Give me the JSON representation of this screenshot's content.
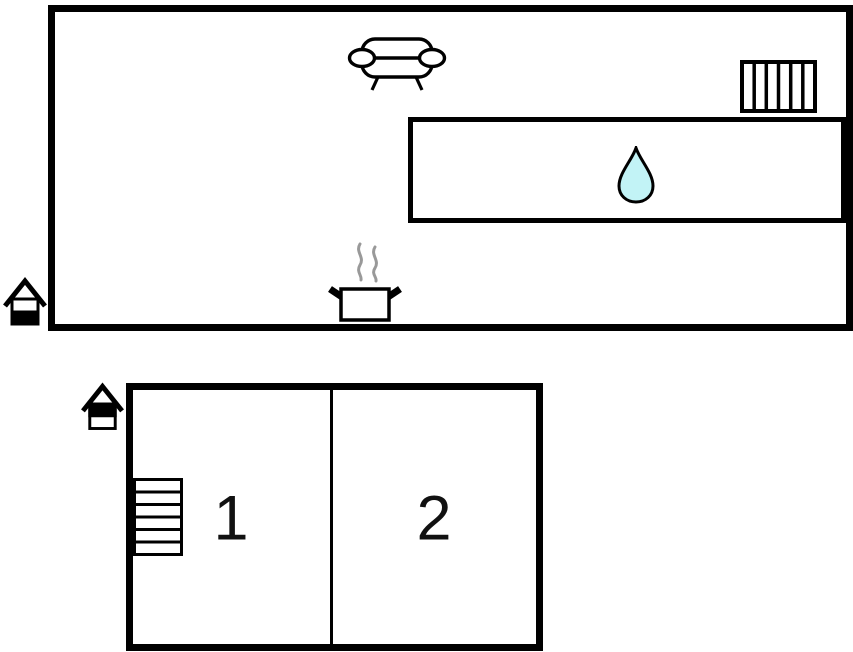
{
  "canvas": {
    "background": "#ffffff",
    "outline_color": "#000000"
  },
  "ground_floor_plan": {
    "icons": {
      "sofa": "sofa-icon",
      "radiator": "radiator-icon",
      "water_drop": "water-drop-icon",
      "cooking_pot": "cooking-pot-icon",
      "level_marker": "house-level-icon-lower-half-filled"
    },
    "water_drop_fill": "#c2f3f6",
    "steam_color": "#999999"
  },
  "upper_floor_plan": {
    "rooms": [
      {
        "label": "1"
      },
      {
        "label": "2"
      }
    ],
    "icons": {
      "stairs": "stairs-icon",
      "level_marker": "house-level-icon-upper-half-filled"
    }
  }
}
